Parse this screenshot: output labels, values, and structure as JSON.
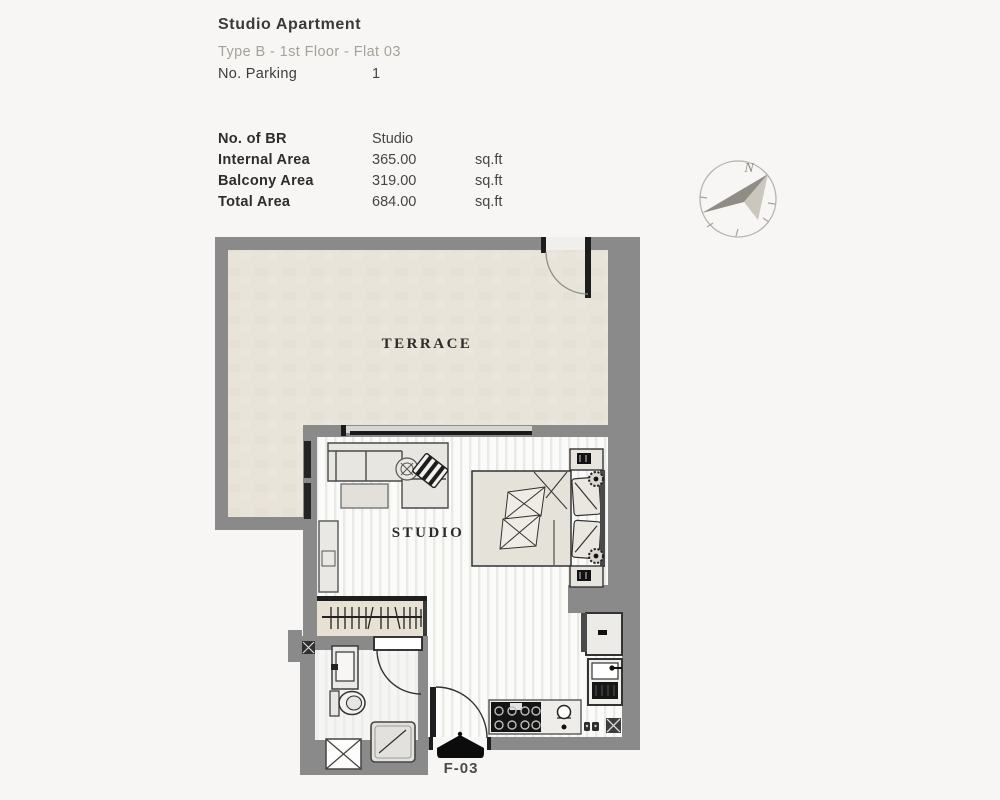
{
  "page": {
    "background": "#f7f6f4"
  },
  "header": {
    "title": "Studio Apartment",
    "subtitle": "Type B - 1st Floor - Flat 03",
    "parking": {
      "label": "No. Parking",
      "value": "1"
    }
  },
  "info_table": {
    "rows": [
      {
        "label": "No. of BR",
        "value": "Studio",
        "unit": ""
      },
      {
        "label": "Internal Area",
        "value": "365.00",
        "unit": "sq.ft"
      },
      {
        "label": "Balcony Area",
        "value": "319.00",
        "unit": "sq.ft"
      },
      {
        "label": "Total Area",
        "value": "684.00",
        "unit": "sq.ft"
      }
    ]
  },
  "compass": {
    "north_label": "N",
    "arrow_direction": "northeast"
  },
  "floor_plan": {
    "room_labels": {
      "terrace": "TERRACE",
      "studio": "STUDIO"
    },
    "unit_marker_label": "F-03",
    "colors": {
      "wall": "#8a8a8a",
      "terrace_floor": "#e9e4d9",
      "plank_floor": "#fbfbf9",
      "entry_marker": "#0c0c0c"
    },
    "fixtures": [
      "terrace-door",
      "sliding-window",
      "sofa",
      "armchair",
      "coffee-table",
      "plant",
      "tv-unit",
      "double-bed",
      "pillows",
      "nightstands",
      "bedside-lamps",
      "wardrobe-rail",
      "bathroom-door",
      "vanity-sink",
      "toilet",
      "shower",
      "service-shaft",
      "entry-door",
      "stove",
      "kitchen-sink",
      "fridge",
      "sink-unit"
    ]
  }
}
